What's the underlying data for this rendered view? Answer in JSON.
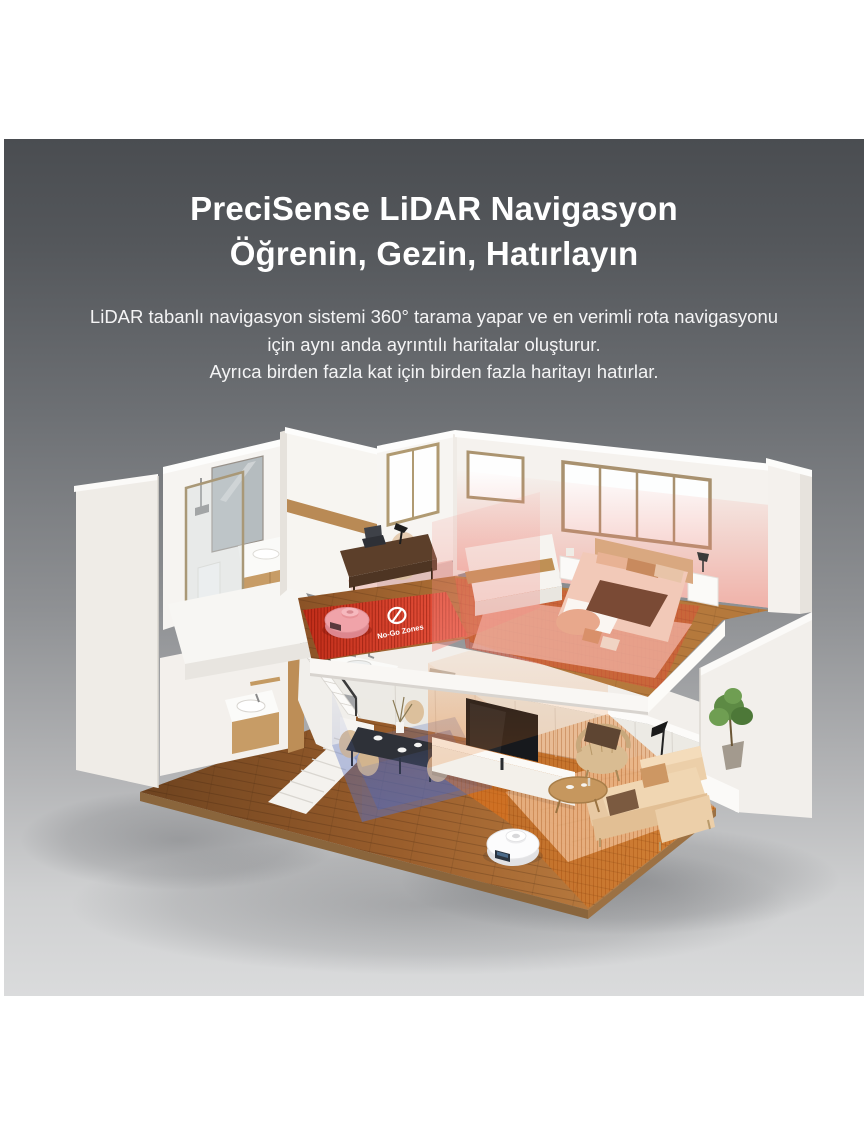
{
  "banner": {
    "title_lines": [
      "PreciSense LiDAR Navigasyon",
      "Öğrenin, Gezin, Hatırlayın"
    ],
    "body_lines": [
      "LiDAR tabanlı navigasyon sistemi 360° tarama yapar ve en verimli rota navigasyonu",
      "için aynı anda ayrıntılı haritalar oluşturur.",
      "Ayrıca birden fazla kat için birden fazla haritayı hatırlar."
    ],
    "text_color": "#ffffff",
    "background_top": "#4a4d51",
    "background_bottom": "#dadbdc"
  },
  "illustration": {
    "no_go_zone": {
      "label": "No-Go Zones",
      "icon": "prohibition-icon",
      "color": "#df3424"
    },
    "scan_zone_color": "#e8761c",
    "mop_zone_color": "#5b74c0",
    "bedroom_scan_color": "#ef8f86",
    "robots": {
      "upper": {
        "name": "robot-vacuum-upper-floor",
        "color": "#f2a6ab"
      },
      "lower": {
        "name": "robot-vacuum-lower-floor",
        "color": "#ffffff"
      }
    }
  }
}
